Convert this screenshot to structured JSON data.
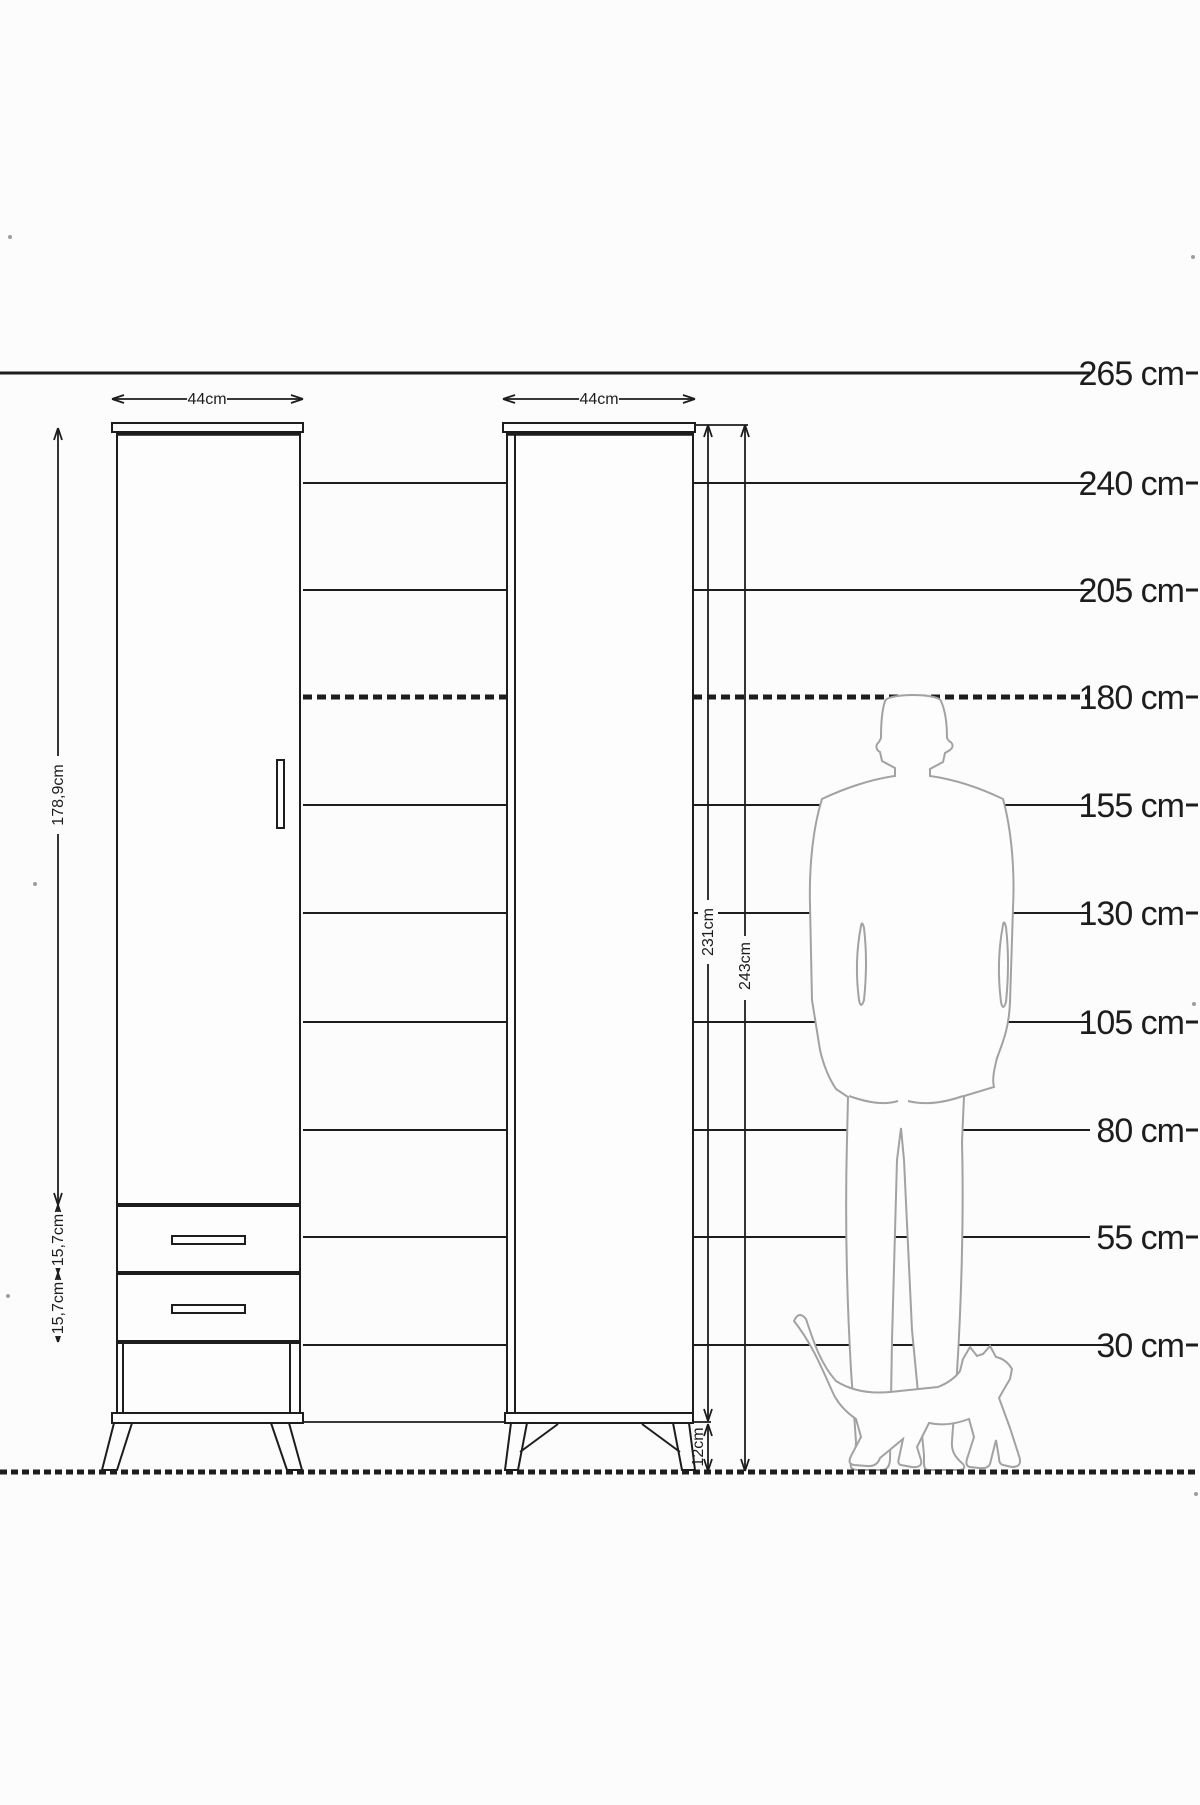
{
  "page": {
    "title": "Wardrobe dimension diagram with human scale",
    "background": "#fcfcfc"
  },
  "ruler": {
    "unit": "cm",
    "labels": [
      "265 cm",
      "240 cm",
      "205 cm",
      "180 cm",
      "155 cm",
      "130 cm",
      "105 cm",
      "80 cm",
      "55 cm",
      "30 cm"
    ],
    "values_cm": [
      265,
      240,
      205,
      180,
      155,
      130,
      105,
      80,
      55,
      30
    ],
    "highlighted_label": "180 cm",
    "highlighted_value_cm": 180
  },
  "left_wardrobe": {
    "width_label": "44cm",
    "door_height_label": "178,9cm",
    "top_drawer_height_label": "15,7cm",
    "bottom_drawer_height_label": "15,7cm",
    "drawer_count": 2
  },
  "right_wardrobe": {
    "width_label": "44cm",
    "cabinet_height_label": "231cm",
    "total_height_label": "243cm",
    "leg_height_label": "12cm"
  },
  "figures": {
    "man": "standing-man-back-view-silhouette",
    "cat": "walking-cat-silhouette"
  },
  "colors": {
    "line": "#1d1d1d",
    "silhouette_outline": "#a2a2a2",
    "background": "#fcfcfc"
  }
}
